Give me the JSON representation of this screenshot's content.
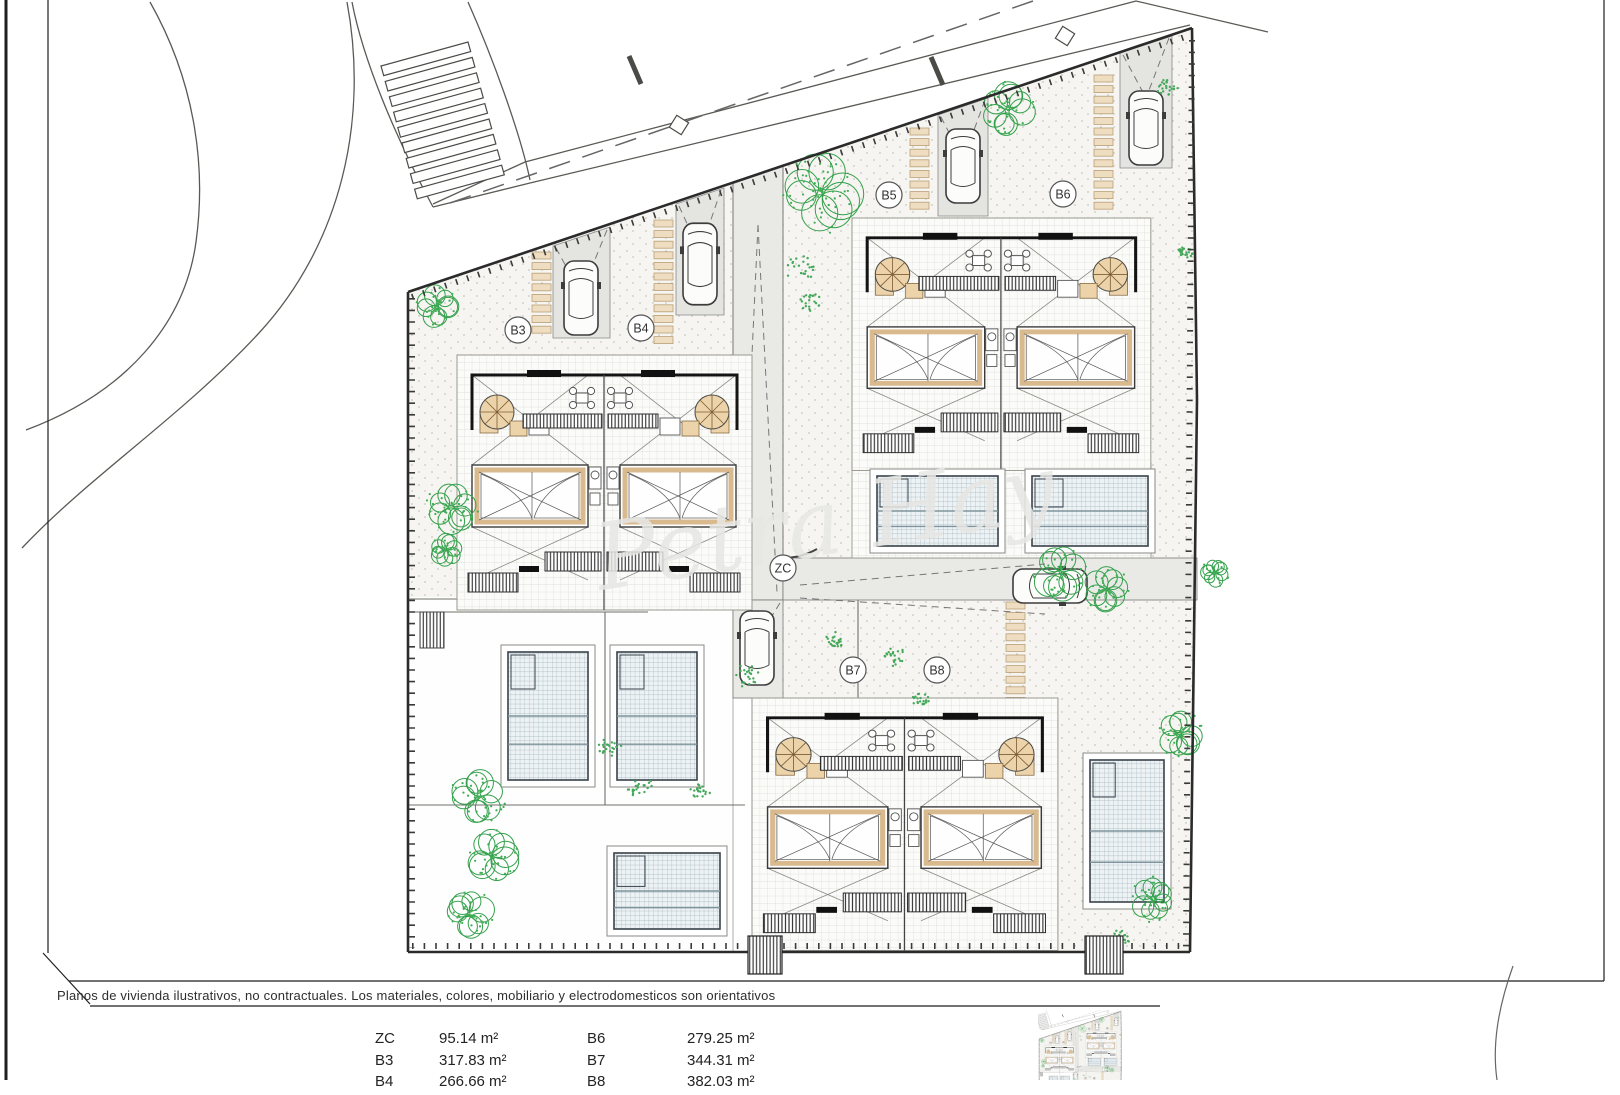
{
  "plan": {
    "labels": {
      "b3": "B3",
      "b4": "B4",
      "b5": "B5",
      "b6": "B6",
      "b7": "B7",
      "b8": "B8",
      "zc": "ZC"
    },
    "watermark": "Petra Hay"
  },
  "footer": {
    "disclaimer": "Planos de vivienda ilustrativos, no contractuales. Los materiales, colores, mobiliario y electrodomesticos son orientativos",
    "area_table": {
      "col1": [
        {
          "label": "ZC",
          "value": "95.14 m²"
        },
        {
          "label": "B3",
          "value": "317.83 m²"
        },
        {
          "label": "B4",
          "value": "266.66 m²"
        }
      ],
      "col2": [
        {
          "label": "B6",
          "value": "279.25 m²"
        },
        {
          "label": "B7",
          "value": "344.31 m²"
        },
        {
          "label": "B8",
          "value": "382.03 m²"
        }
      ]
    }
  },
  "colors": {
    "line": "#2b2b2b",
    "wood_tan": "#ecd3a9",
    "tree_green": "#3aa24e",
    "pool_water": "#edf2f4",
    "gravel": "#f6f5f1",
    "hardscape": "#e9e9e6"
  }
}
